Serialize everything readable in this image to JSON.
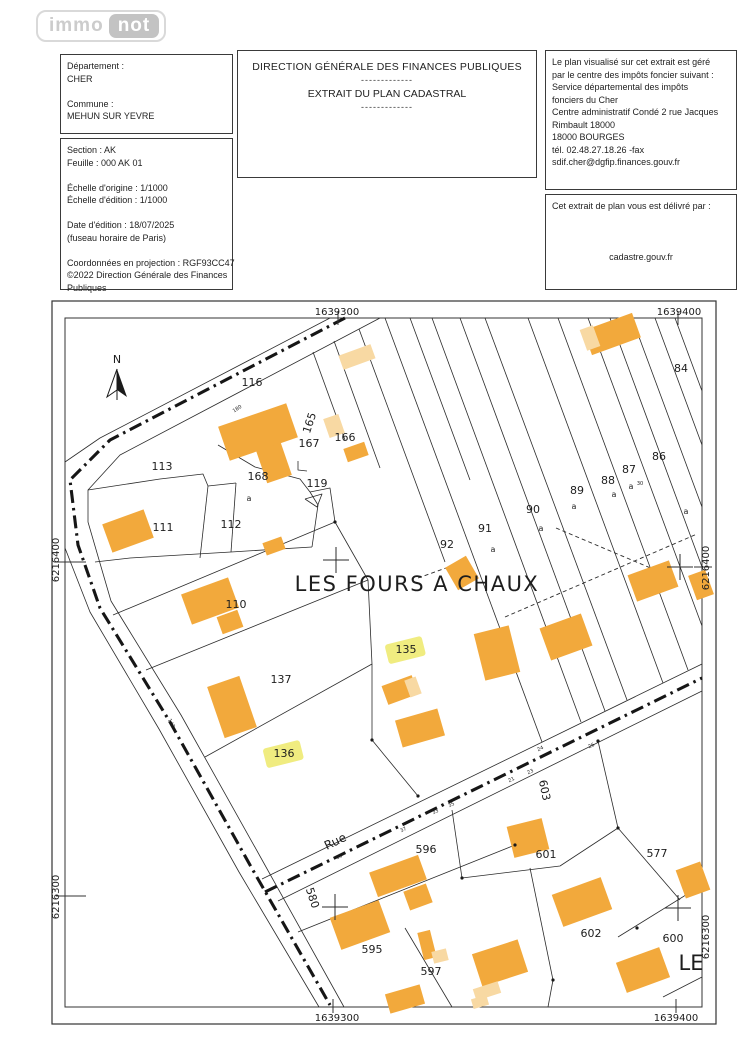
{
  "logo": {
    "immo": "immo",
    "not": "not"
  },
  "header": {
    "left1": {
      "lines": [
        "Département :",
        "CHER",
        "",
        "Commune :",
        "MEHUN SUR YEVRE"
      ]
    },
    "left2": {
      "lines": [
        "Section : AK",
        "Feuille : 000 AK 01",
        "",
        "Échelle d'origine : 1/1000",
        "Échelle d'édition : 1/1000",
        "",
        "Date d'édition : 18/07/2025",
        "(fuseau horaire de Paris)",
        "",
        "Coordonnées en projection : RGF93CC47",
        "©2022 Direction Générale des Finances",
        "Publiques"
      ]
    },
    "center": {
      "title": "DIRECTION GÉNÉRALE DES FINANCES PUBLIQUES",
      "dashes1": "-------------",
      "subtitle": "EXTRAIT DU PLAN CADASTRAL",
      "dashes2": "-------------"
    },
    "right1": {
      "lines": [
        "Le plan visualisé sur cet extrait est géré",
        "par le centre des impôts foncier suivant :",
        "Service départemental des impôts",
        "fonciers du Cher",
        "Centre administratif Condé 2 rue Jacques",
        "Rimbault 18000",
        "18000 BOURGES",
        "tél. 02.48.27.18.26 -fax",
        "sdif.cher@dgfip.finances.gouv.fr"
      ]
    },
    "right2": {
      "title": "Cet extrait de plan vous est délivré par :",
      "host": "cadastre.gouv.fr"
    }
  },
  "map": {
    "colors": {
      "building": "#F2A93C",
      "building_light": "#F8D9A3",
      "highlight": "#F0EC80",
      "line": "#2b2b2b",
      "road": "#161616",
      "text": "#1d1d1d"
    },
    "north_label": "N",
    "lieu_dit": "LES FOURS A CHAUX",
    "partial_lieu_dit": "LE",
    "street_label": {
      "t": "Rue",
      "x": 337,
      "y": 845,
      "r": -26,
      "s": 12
    },
    "coords": [
      {
        "t": "1639300",
        "x": 337,
        "y": 315,
        "r": 0
      },
      {
        "t": "1639400",
        "x": 679,
        "y": 315,
        "r": 0
      },
      {
        "t": "1639300",
        "x": 337,
        "y": 1021,
        "r": 0
      },
      {
        "t": "1639400",
        "x": 676,
        "y": 1021,
        "r": 0
      },
      {
        "t": "6216400",
        "x": 59,
        "y": 560,
        "r": -90
      },
      {
        "t": "6216300",
        "x": 59,
        "y": 897,
        "r": -90
      },
      {
        "t": "6216400",
        "x": 709,
        "y": 568,
        "r": -90
      },
      {
        "t": "6216300",
        "x": 709,
        "y": 937,
        "r": -90
      }
    ],
    "parcel_labels": [
      {
        "t": "116",
        "x": 252,
        "y": 386
      },
      {
        "t": "113",
        "x": 162,
        "y": 470
      },
      {
        "t": "111",
        "x": 163,
        "y": 531
      },
      {
        "t": "112",
        "x": 231,
        "y": 528
      },
      {
        "t": "168",
        "x": 258,
        "y": 480
      },
      {
        "t": "119",
        "x": 317,
        "y": 487
      },
      {
        "t": "167",
        "x": 309,
        "y": 447
      },
      {
        "t": "166",
        "x": 345,
        "y": 441
      },
      {
        "t": "165",
        "x": 313,
        "y": 424,
        "r": -72
      },
      {
        "t": "110",
        "x": 236,
        "y": 608
      },
      {
        "t": "137",
        "x": 281,
        "y": 683
      },
      {
        "t": "92",
        "x": 447,
        "y": 548
      },
      {
        "t": "91",
        "x": 485,
        "y": 532
      },
      {
        "t": "90",
        "x": 533,
        "y": 513
      },
      {
        "t": "89",
        "x": 577,
        "y": 494
      },
      {
        "t": "88",
        "x": 608,
        "y": 484
      },
      {
        "t": "87",
        "x": 629,
        "y": 473
      },
      {
        "t": "86",
        "x": 659,
        "y": 460
      },
      {
        "t": "84",
        "x": 681,
        "y": 372
      },
      {
        "t": "596",
        "x": 426,
        "y": 853
      },
      {
        "t": "601",
        "x": 546,
        "y": 858
      },
      {
        "t": "577",
        "x": 657,
        "y": 857
      },
      {
        "t": "595",
        "x": 372,
        "y": 953
      },
      {
        "t": "597",
        "x": 431,
        "y": 975
      },
      {
        "t": "602",
        "x": 591,
        "y": 937
      },
      {
        "t": "600",
        "x": 673,
        "y": 942
      },
      {
        "t": "580",
        "x": 309,
        "y": 899,
        "r": 72
      },
      {
        "t": "603",
        "x": 541,
        "y": 791,
        "r": 78
      }
    ],
    "highlighted_labels": [
      {
        "t": "135",
        "x": 406,
        "y": 653
      },
      {
        "t": "136",
        "x": 284,
        "y": 757
      }
    ],
    "sub_labels": [
      {
        "t": "a",
        "x": 249,
        "y": 501
      },
      {
        "t": "a",
        "x": 493,
        "y": 552
      },
      {
        "t": "a",
        "x": 541,
        "y": 531
      },
      {
        "t": "a",
        "x": 574,
        "y": 509
      },
      {
        "t": "a",
        "x": 614,
        "y": 497
      },
      {
        "t": "a",
        "x": 631,
        "y": 489
      },
      {
        "t": "30",
        "x": 640,
        "y": 485,
        "s": 5
      },
      {
        "t": "a",
        "x": 686,
        "y": 514
      }
    ],
    "tiny_labels": [
      {
        "t": "39",
        "x": 340,
        "y": 858,
        "r": -26
      },
      {
        "t": "37",
        "x": 404,
        "y": 831,
        "r": -26
      },
      {
        "t": "35",
        "x": 452,
        "y": 806,
        "r": -26
      },
      {
        "t": "33",
        "x": 436,
        "y": 813,
        "r": -26
      },
      {
        "t": "21",
        "x": 512,
        "y": 781,
        "r": -26
      },
      {
        "t": "23",
        "x": 531,
        "y": 773,
        "r": -26
      },
      {
        "t": "24",
        "x": 541,
        "y": 750,
        "r": -26
      },
      {
        "t": "26",
        "x": 592,
        "y": 747,
        "r": -26
      },
      {
        "t": "180",
        "x": 238,
        "y": 410,
        "r": -33
      },
      {
        "t": "142",
        "x": 170,
        "y": 724,
        "r": 62
      }
    ],
    "frames": {
      "outer": [
        52,
        301,
        716,
        1024
      ],
      "inner": [
        65,
        318,
        702,
        1007
      ]
    },
    "road_centerlines": [
      [
        [
          345,
          318
        ],
        [
          110,
          440
        ],
        [
          70,
          480
        ],
        [
          78,
          545
        ],
        [
          100,
          608
        ],
        [
          170,
          722
        ],
        [
          250,
          865
        ],
        [
          330,
          1005
        ]
      ],
      [
        [
          265,
          892
        ],
        [
          702,
          678
        ]
      ]
    ],
    "solid_lines": [
      [
        [
          380,
          318
        ],
        [
          120,
          455
        ],
        [
          88,
          490
        ],
        [
          88,
          522
        ],
        [
          111,
          601
        ],
        [
          181,
          715
        ],
        [
          261,
          858
        ],
        [
          344,
          1007
        ]
      ],
      [
        [
          330,
          318
        ],
        [
          100,
          438
        ],
        [
          65,
          462
        ]
      ],
      [
        [
          65,
          548
        ],
        [
          90,
          612
        ],
        [
          159,
          729
        ],
        [
          239,
          872
        ],
        [
          319,
          1007
        ]
      ],
      [
        [
          262,
          879
        ],
        [
          702,
          664
        ]
      ],
      [
        [
          278,
          901
        ],
        [
          702,
          691
        ]
      ],
      [
        [
          88,
          490
        ],
        [
          160,
          479
        ],
        [
          203,
          474
        ],
        [
          208,
          486
        ],
        [
          236,
          483
        ]
      ],
      [
        [
          208,
          486
        ],
        [
          200,
          558
        ]
      ],
      [
        [
          236,
          483
        ],
        [
          231,
          552
        ]
      ],
      [
        [
          95,
          562
        ],
        [
          130,
          558
        ],
        [
          231,
          552
        ],
        [
          312,
          547
        ]
      ],
      [
        [
          312,
          547
        ],
        [
          318,
          505
        ],
        [
          310,
          492
        ]
      ],
      [
        [
          310,
          492
        ],
        [
          330,
          488
        ],
        [
          335,
          522
        ]
      ],
      [
        [
          218,
          445
        ],
        [
          255,
          467
        ],
        [
          300,
          479
        ],
        [
          310,
          492
        ]
      ],
      [
        [
          298,
          461
        ],
        [
          298,
          470
        ],
        [
          307,
          471
        ]
      ],
      [
        [
          305,
          499
        ],
        [
          322,
          494
        ],
        [
          317,
          507
        ],
        [
          305,
          499
        ]
      ],
      [
        [
          113,
          615
        ],
        [
          335,
          522
        ]
      ],
      [
        [
          146,
          670
        ],
        [
          368,
          580
        ]
      ],
      [
        [
          205,
          757
        ],
        [
          372,
          664
        ]
      ],
      [
        [
          335,
          522
        ],
        [
          368,
          580
        ],
        [
          372,
          664
        ],
        [
          372,
          740
        ],
        [
          418,
          796
        ]
      ],
      [
        [
          313,
          352
        ],
        [
          345,
          440
        ]
      ],
      [
        [
          334,
          341
        ],
        [
          380,
          468
        ]
      ],
      [
        [
          359,
          329
        ],
        [
          445,
          562
        ]
      ],
      [
        [
          385,
          318
        ],
        [
          542,
          742
        ]
      ],
      [
        [
          410,
          318
        ],
        [
          470,
          480
        ]
      ],
      [
        [
          432,
          318
        ],
        [
          581,
          722
        ]
      ],
      [
        [
          460,
          318
        ],
        [
          605,
          711
        ]
      ],
      [
        [
          485,
          318
        ],
        [
          627,
          700
        ]
      ],
      [
        [
          528,
          318
        ],
        [
          663,
          683
        ]
      ],
      [
        [
          558,
          318
        ],
        [
          688,
          670
        ]
      ],
      [
        [
          588,
          318
        ],
        [
          702,
          626
        ]
      ],
      [
        [
          610,
          318
        ],
        [
          702,
          567
        ]
      ],
      [
        [
          632,
          318
        ],
        [
          702,
          507
        ]
      ],
      [
        [
          655,
          318
        ],
        [
          702,
          445
        ]
      ],
      [
        [
          675,
          318
        ],
        [
          702,
          391
        ]
      ],
      [
        [
          298,
          932
        ],
        [
          515,
          845
        ]
      ],
      [
        [
          452,
          810
        ],
        [
          462,
          878
        ]
      ],
      [
        [
          462,
          878
        ],
        [
          560,
          866
        ],
        [
          618,
          828
        ]
      ],
      [
        [
          598,
          741
        ],
        [
          618,
          828
        ]
      ],
      [
        [
          618,
          828
        ],
        [
          680,
          900
        ]
      ],
      [
        [
          618,
          937
        ],
        [
          702,
          885
        ]
      ],
      [
        [
          530,
          868
        ],
        [
          553,
          980
        ],
        [
          548,
          1007
        ]
      ],
      [
        [
          405,
          928
        ],
        [
          452,
          1007
        ]
      ],
      [
        [
          663,
          997
        ],
        [
          702,
          977
        ]
      ]
    ],
    "dashed_lines": [
      [
        [
          418,
          578
        ],
        [
          460,
          563
        ]
      ],
      [
        [
          505,
          617
        ],
        [
          697,
          534
        ]
      ],
      [
        [
          556,
          528
        ],
        [
          660,
          572
        ]
      ]
    ],
    "buildings": [
      [
        612,
        334,
        52,
        26,
        -20,
        "d"
      ],
      [
        590,
        338,
        14,
        22,
        -20,
        "l"
      ],
      [
        357,
        357,
        34,
        15,
        -20,
        "l"
      ],
      [
        258,
        432,
        72,
        36,
        -19,
        "d"
      ],
      [
        274,
        463,
        26,
        34,
        -19,
        "d"
      ],
      [
        334,
        426,
        16,
        20,
        -19,
        "l"
      ],
      [
        356,
        452,
        22,
        14,
        -19,
        "d"
      ],
      [
        128,
        531,
        44,
        30,
        -20,
        "d"
      ],
      [
        274,
        546,
        20,
        13,
        -20,
        "d"
      ],
      [
        210,
        601,
        50,
        32,
        -20,
        "d"
      ],
      [
        230,
        622,
        22,
        18,
        -20,
        "d"
      ],
      [
        232,
        707,
        34,
        54,
        -19,
        "d"
      ],
      [
        653,
        581,
        44,
        28,
        -20,
        "d"
      ],
      [
        701,
        585,
        18,
        26,
        -20,
        "d"
      ],
      [
        462,
        573,
        24,
        26,
        -30,
        "d"
      ],
      [
        497,
        653,
        36,
        48,
        -14,
        "d"
      ],
      [
        566,
        637,
        44,
        34,
        -20,
        "d"
      ],
      [
        400,
        690,
        32,
        20,
        -20,
        "d"
      ],
      [
        413,
        687,
        12,
        18,
        -20,
        "l"
      ],
      [
        420,
        728,
        44,
        28,
        -16,
        "d"
      ],
      [
        528,
        838,
        36,
        32,
        -14,
        "d"
      ],
      [
        398,
        876,
        52,
        26,
        -20,
        "d"
      ],
      [
        418,
        897,
        24,
        20,
        -20,
        "d"
      ],
      [
        360,
        925,
        52,
        34,
        -20,
        "d"
      ],
      [
        582,
        902,
        52,
        34,
        -20,
        "d"
      ],
      [
        693,
        880,
        26,
        30,
        -20,
        "d"
      ],
      [
        643,
        970,
        46,
        32,
        -20,
        "d"
      ],
      [
        500,
        963,
        48,
        34,
        -18,
        "d"
      ],
      [
        487,
        991,
        26,
        12,
        -18,
        "l"
      ],
      [
        427,
        945,
        13,
        28,
        -14,
        "d"
      ],
      [
        440,
        956,
        15,
        12,
        -14,
        "l"
      ],
      [
        405,
        999,
        36,
        20,
        -16,
        "d"
      ],
      [
        480,
        1002,
        16,
        10,
        -16,
        "l"
      ]
    ],
    "crosses": [
      [
        336,
        560
      ],
      [
        680,
        567
      ],
      [
        335,
        907
      ],
      [
        678,
        908
      ]
    ],
    "dots": [
      [
        372,
        740
      ],
      [
        618,
        828
      ],
      [
        637,
        928
      ],
      [
        553,
        980
      ],
      [
        462,
        878
      ],
      [
        598,
        741
      ],
      [
        515,
        845
      ],
      [
        335,
        522
      ],
      [
        418,
        796
      ]
    ],
    "ticks": [
      [
        [
          338,
          311
        ],
        [
          338,
          325
        ]
      ],
      [
        [
          678,
          311
        ],
        [
          678,
          325
        ]
      ],
      [
        [
          333,
          999
        ],
        [
          333,
          1013
        ]
      ],
      [
        [
          676,
          999
        ],
        [
          676,
          1013
        ]
      ],
      [
        [
          56,
          562
        ],
        [
          86,
          562
        ]
      ],
      [
        [
          56,
          896
        ],
        [
          86,
          896
        ]
      ],
      [
        [
          694,
          567
        ],
        [
          712,
          567
        ]
      ]
    ],
    "lieu_dit_pos": {
      "x": 417,
      "y": 591,
      "s": 21
    },
    "partial_pos": {
      "x": 691,
      "y": 970,
      "s": 21
    },
    "north": {
      "x": 117,
      "y": 363
    }
  }
}
